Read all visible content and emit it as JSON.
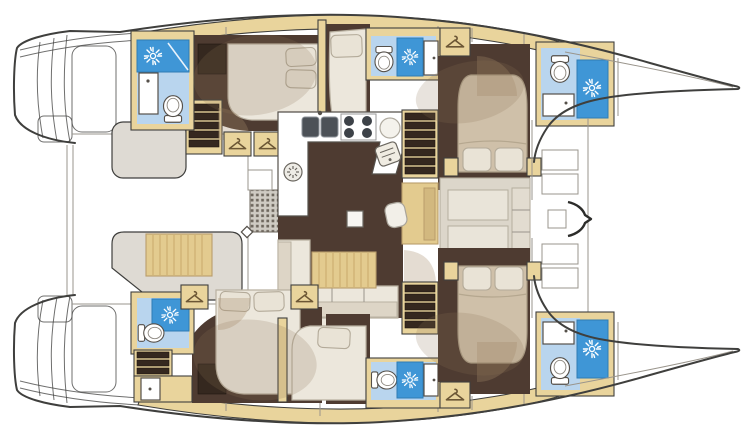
{
  "diagram": {
    "type": "yacht-floor-plan",
    "vessel": "sailing-catamaran",
    "view": "top-down-interior-deck-plan",
    "hull_count": 2,
    "cabin_count": 6,
    "heads_count": 6,
    "orientation": "bows-right-sterns-left"
  },
  "palette": {
    "white": "#ffffff",
    "outline": "#3f3f3d",
    "tan": "#e9d49c",
    "tanWood": "#e3cb8f",
    "tanDark": "#c9a96b",
    "brown": "#4e3b31",
    "brownDark": "#35281f",
    "cream": "#ece7dc",
    "pillow": "#e9e3d6",
    "bedTan": "#cfc0a9",
    "blueLight": "#b9d5ee",
    "blueDark": "#3f96d6",
    "grayLight": "#dedad3"
  },
  "icons": {
    "shower": "sunburst-shower-icon",
    "toilet": "toilet-icon",
    "wardrobe": "hanger-icon",
    "sink": "basin-with-faucet-icon",
    "galley_sink": "double-sink-icon",
    "stove": "four-burner-stove-icon",
    "oven": "oven-icon",
    "vent": "round-vent-icon",
    "grate": "floor-grate-icon",
    "mast_fitting": "mast-bracket-icon"
  },
  "port_hull": {
    "rooms": [
      "aft-heads-with-shower",
      "aft-double-cabin",
      "mid-double-cabin",
      "mid-heads-with-shower",
      "forward-island-bed-cabin",
      "forward-heads-with-shower",
      "bow-locker"
    ],
    "features": [
      "companionway-stairs",
      "two-wardrobes",
      "transom-steps"
    ]
  },
  "starboard_hull": {
    "rooms": [
      "aft-heads-with-shower",
      "aft-double-cabin",
      "mid-double-cabin",
      "mid-heads-with-shower",
      "forward-island-bed-cabin",
      "forward-heads-with-shower",
      "bow-locker"
    ],
    "features": [
      "companionway-stairs",
      "two-wardrobes",
      "transom-steps"
    ]
  },
  "salon": {
    "features": [
      "u-shaped-galley",
      "double-sink",
      "four-burner-stove",
      "prep-sink",
      "oven",
      "round-vent",
      "nav-desk-with-chair",
      "l-shaped-sofa",
      "slatted-coffee-table",
      "side-table",
      "floor-grate",
      "stairs-to-forward-cabins"
    ]
  },
  "cockpit": {
    "features": [
      "aft-cockpit-bench",
      "slatted-cockpit-table",
      "transom-platforms"
    ]
  }
}
